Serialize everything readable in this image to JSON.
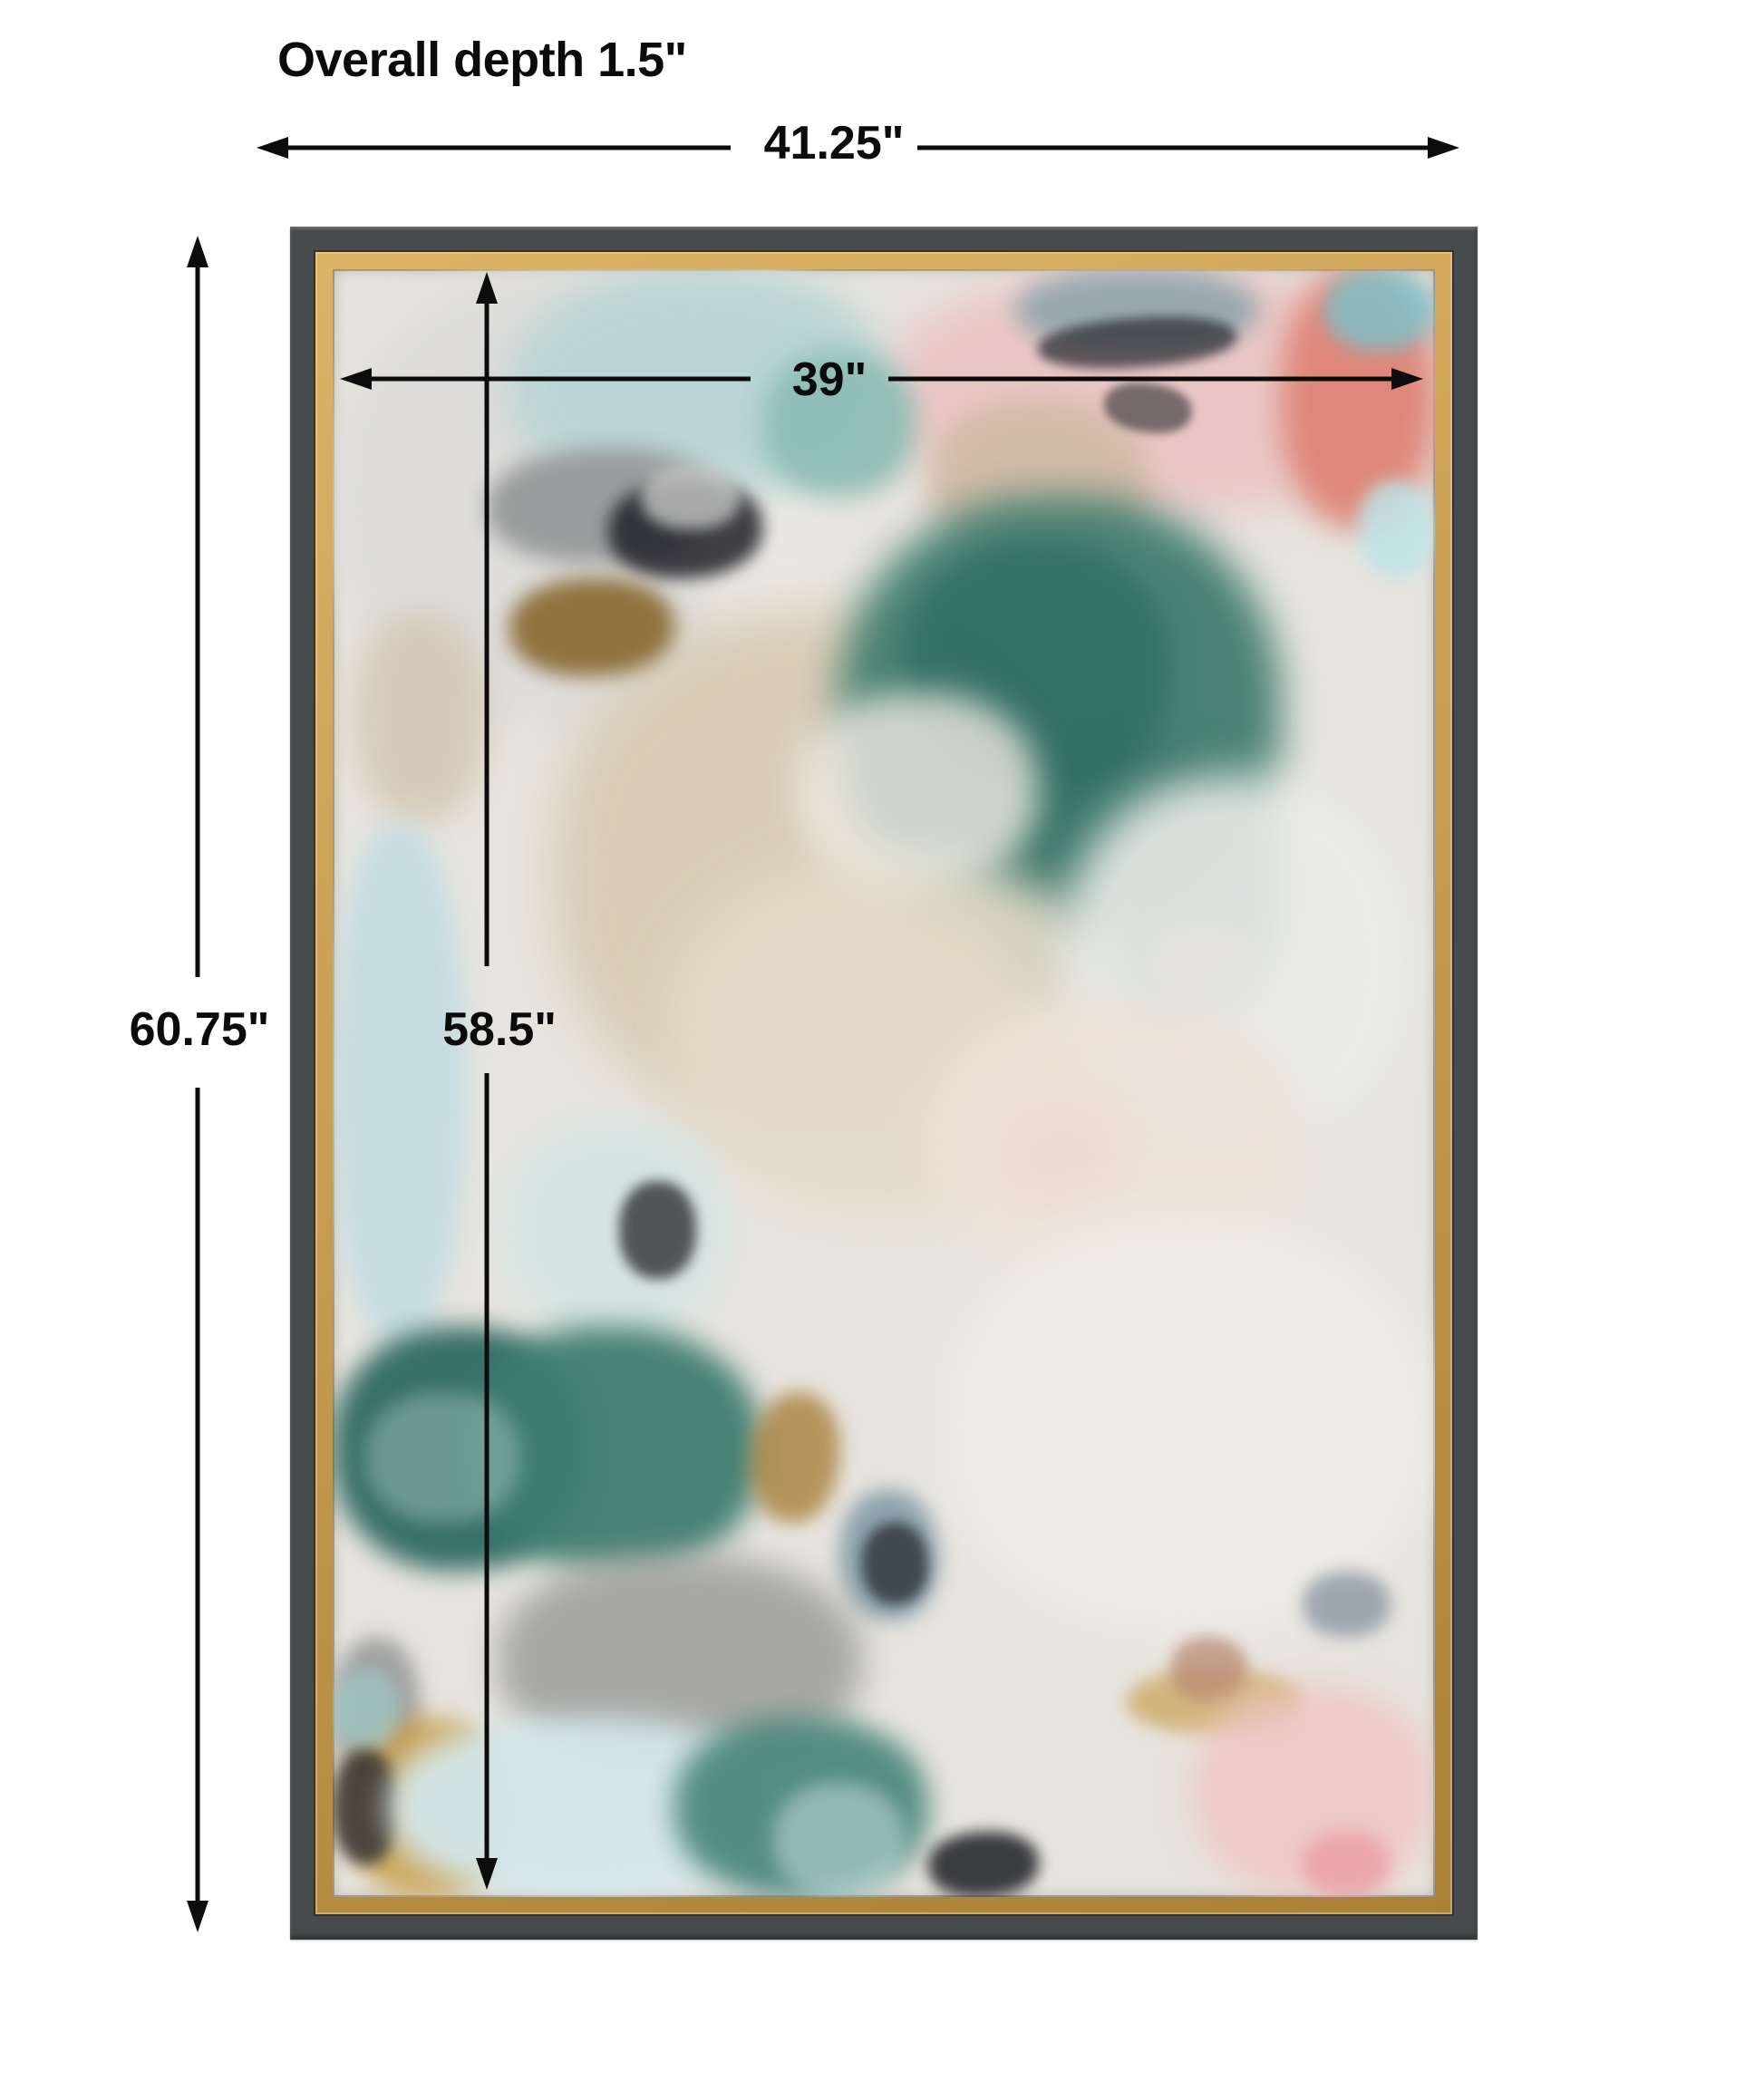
{
  "title": "Overall depth 1.5\"",
  "dimensions": {
    "outer_width": "41.25\"",
    "inner_width": "39\"",
    "outer_height": "60.75\"",
    "inner_height": "58.5\"",
    "depth": "1.5\""
  },
  "frame": {
    "outer_color": "#474b4c",
    "gold_light": "#dcb365",
    "gold_dark": "#ad8038",
    "canvas_base": "#e7e4de",
    "line_color": "#0c0c0c"
  },
  "artwork": {
    "palette": {
      "teal": "#417d6f",
      "dark_teal": "#2e6a61",
      "pale_aqua": "#bad5d3",
      "pale_blue": "#c3dce1",
      "beige": "#d8cbb4",
      "pink": "#e9c6c5",
      "coral": "#dd7d6e",
      "gray": "#97999a",
      "black": "#212228",
      "gold": "#c89f4b",
      "white": "#efece6"
    },
    "patches": [
      [
        0,
        0,
        42,
        28,
        "#dddcda",
        26,
        1,
        0
      ],
      [
        33,
        0,
        12,
        26,
        "#ebe8e3",
        20,
        0.9,
        0
      ],
      [
        50,
        0,
        50,
        15,
        "#e9c6c5",
        24,
        1,
        0
      ],
      [
        16,
        0,
        34,
        14,
        "#bad5d3",
        22,
        1,
        -3
      ],
      [
        39,
        5,
        14,
        9,
        "#8cbcb3",
        14,
        0.9,
        0
      ],
      [
        62,
        0,
        22,
        5,
        "#91a6ac",
        13,
        0.9,
        0
      ],
      [
        86,
        0,
        14,
        16,
        "#dd7d6e",
        16,
        0.85,
        0
      ],
      [
        90,
        0,
        10,
        5,
        "#7ac2ca",
        10,
        0.8,
        0
      ],
      [
        54,
        8,
        20,
        10,
        "#d0baa4",
        16,
        0.9,
        0
      ],
      [
        93,
        13,
        7,
        6,
        "#bfe3e6",
        9,
        0.85,
        0
      ],
      [
        64,
        3,
        18,
        3,
        "#26282d",
        6,
        0.7,
        -4
      ],
      [
        70,
        7,
        8,
        3,
        "#2a2c31",
        5,
        0.6,
        8
      ],
      [
        2,
        21,
        12,
        13,
        "#d4c8b4",
        18,
        0.9,
        0
      ],
      [
        20,
        21,
        48,
        32,
        "#d8cbb4",
        28,
        0.95,
        0
      ],
      [
        46,
        14,
        40,
        27,
        "#417d6f",
        22,
        0.95,
        0
      ],
      [
        60,
        29,
        26,
        18,
        "#3a7568",
        20,
        0.95,
        0
      ],
      [
        52,
        17,
        24,
        15,
        "#2d6a60",
        14,
        0.7,
        0
      ],
      [
        74,
        40,
        10,
        5,
        "#c09a43",
        10,
        0.65,
        0
      ],
      [
        14,
        11,
        21,
        7,
        "#97999a",
        12,
        0.95,
        -2
      ],
      [
        25,
        13,
        14,
        6,
        "#212228",
        9,
        0.85,
        -3
      ],
      [
        16,
        19,
        15,
        6,
        "#87682f",
        11,
        0.9,
        -2
      ],
      [
        28,
        12,
        9,
        4,
        "#cfd0ce",
        8,
        0.75,
        0
      ],
      [
        0,
        34,
        12,
        32,
        "#c3dce1",
        15,
        0.95,
        0
      ],
      [
        30,
        36,
        42,
        22,
        "#e4dac7",
        24,
        0.9,
        0
      ],
      [
        66,
        31,
        32,
        23,
        "#ebece9",
        24,
        0.9,
        0
      ],
      [
        42,
        26,
        22,
        12,
        "#eee9e1",
        18,
        0.8,
        0
      ],
      [
        54,
        45,
        34,
        17,
        "#eee2d8",
        22,
        0.9,
        0
      ],
      [
        60,
        51,
        12,
        7,
        "#ecd8d2",
        14,
        0.6,
        0
      ],
      [
        15,
        52,
        21,
        14,
        "#d5e4e2",
        16,
        0.9,
        0
      ],
      [
        26,
        56,
        7,
        6,
        "#23252a",
        7,
        0.75,
        0
      ],
      [
        0,
        65,
        23,
        15,
        "#2e6a61",
        14,
        0.95,
        -2
      ],
      [
        12,
        65,
        27,
        15,
        "#3f7d6f",
        16,
        0.95,
        2
      ],
      [
        3,
        69,
        14,
        8,
        "#b9d2cf",
        10,
        0.4,
        0
      ],
      [
        38,
        69,
        8,
        8,
        "#a9813c",
        10,
        0.8,
        6
      ],
      [
        46,
        75,
        9,
        8,
        "#7e97a4",
        11,
        0.85,
        0
      ],
      [
        48,
        77,
        6,
        5,
        "#202228",
        7,
        0.7,
        0
      ],
      [
        55,
        58,
        45,
        26,
        "#efece6",
        28,
        0.95,
        0
      ],
      [
        88,
        80,
        8,
        4,
        "#8b98a2",
        9,
        0.8,
        0
      ],
      [
        72,
        86,
        16,
        4,
        "#c8a254",
        9,
        0.7,
        0
      ],
      [
        76,
        84,
        7,
        4,
        "#b98a74",
        8,
        0.75,
        0
      ],
      [
        78,
        87,
        22,
        13,
        "#efc5c3",
        20,
        0.85,
        0
      ],
      [
        88,
        96,
        8,
        4,
        "#ea96a0",
        9,
        0.7,
        0
      ],
      [
        15,
        79,
        33,
        13,
        "#a4a5a1",
        18,
        0.95,
        0
      ],
      [
        0,
        84,
        8,
        9,
        "#97999a",
        11,
        0.85,
        0
      ],
      [
        1,
        89,
        15,
        11,
        "#c89f4b",
        13,
        0.85,
        0
      ],
      [
        0,
        86,
        6,
        5,
        "#9fc9c6",
        8,
        0.7,
        0
      ],
      [
        0,
        91,
        6,
        7,
        "#2a2b2f",
        8,
        0.8,
        0
      ],
      [
        5,
        89,
        36,
        11,
        "#d3e6e9",
        16,
        0.95,
        0
      ],
      [
        31,
        89,
        23,
        11,
        "#4d897d",
        15,
        0.95,
        0
      ],
      [
        54,
        96,
        10,
        4,
        "#1e2025",
        8,
        0.85,
        -3
      ],
      [
        40,
        93,
        12,
        7,
        "#cfe3e4",
        10,
        0.5,
        0
      ]
    ]
  }
}
